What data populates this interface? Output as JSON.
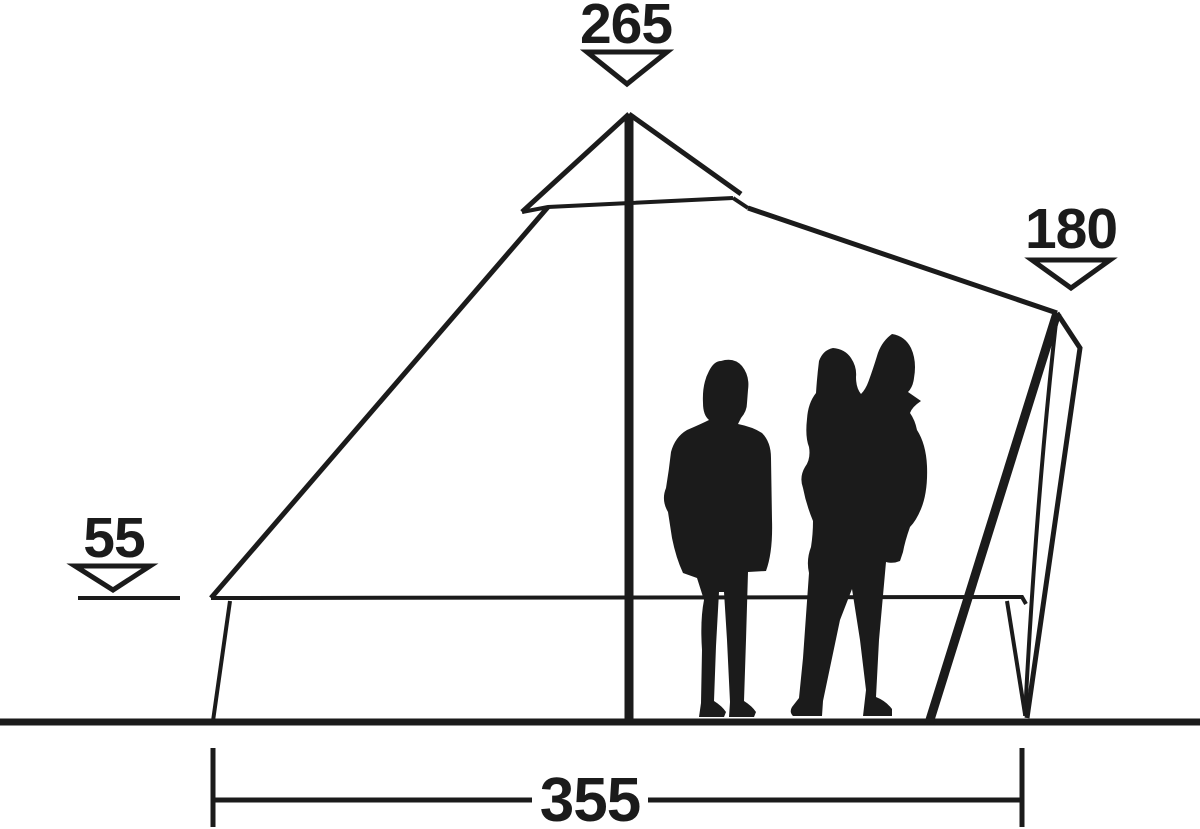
{
  "diagram": {
    "kind": "tent-side-view-dimension-diagram",
    "measurements": {
      "peak_height": {
        "value": "265"
      },
      "door_height": {
        "value": "180"
      },
      "wall_height": {
        "value": "55"
      },
      "floor_width": {
        "value": "355"
      }
    }
  },
  "colors": {
    "ink": "#1b1b1b",
    "paper": "#ffffff"
  }
}
